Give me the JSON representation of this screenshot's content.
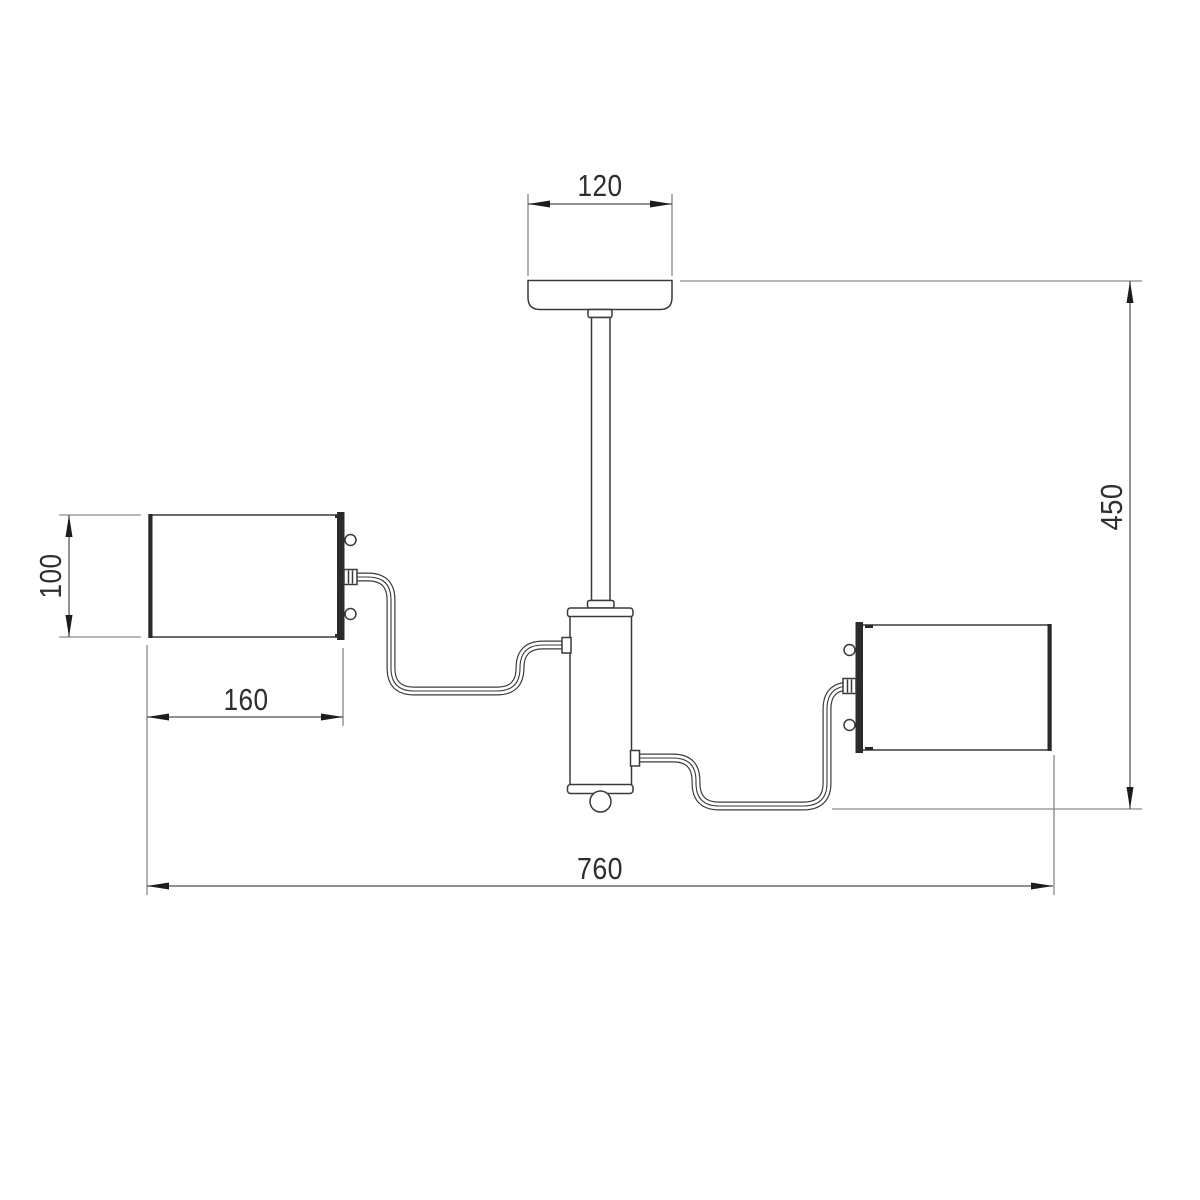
{
  "drawing": {
    "kind": "two-arm ceiling lamp dimension drawing",
    "background": "#ffffff"
  },
  "dimensions": {
    "canopy_width": "120",
    "overall_height": "450",
    "shade_height": "100",
    "shade_width": "160",
    "overall_width": "760"
  },
  "colors": {
    "object_line": "#3a3a3a",
    "thick_edge": "#2a2a2a",
    "back_plate": "#2b2b2b",
    "extension_line": "#8a8a8a",
    "dimension_line": "#4d4d4d",
    "arrowhead": "#1c1c1c",
    "label_text": "#2e2e2e"
  }
}
